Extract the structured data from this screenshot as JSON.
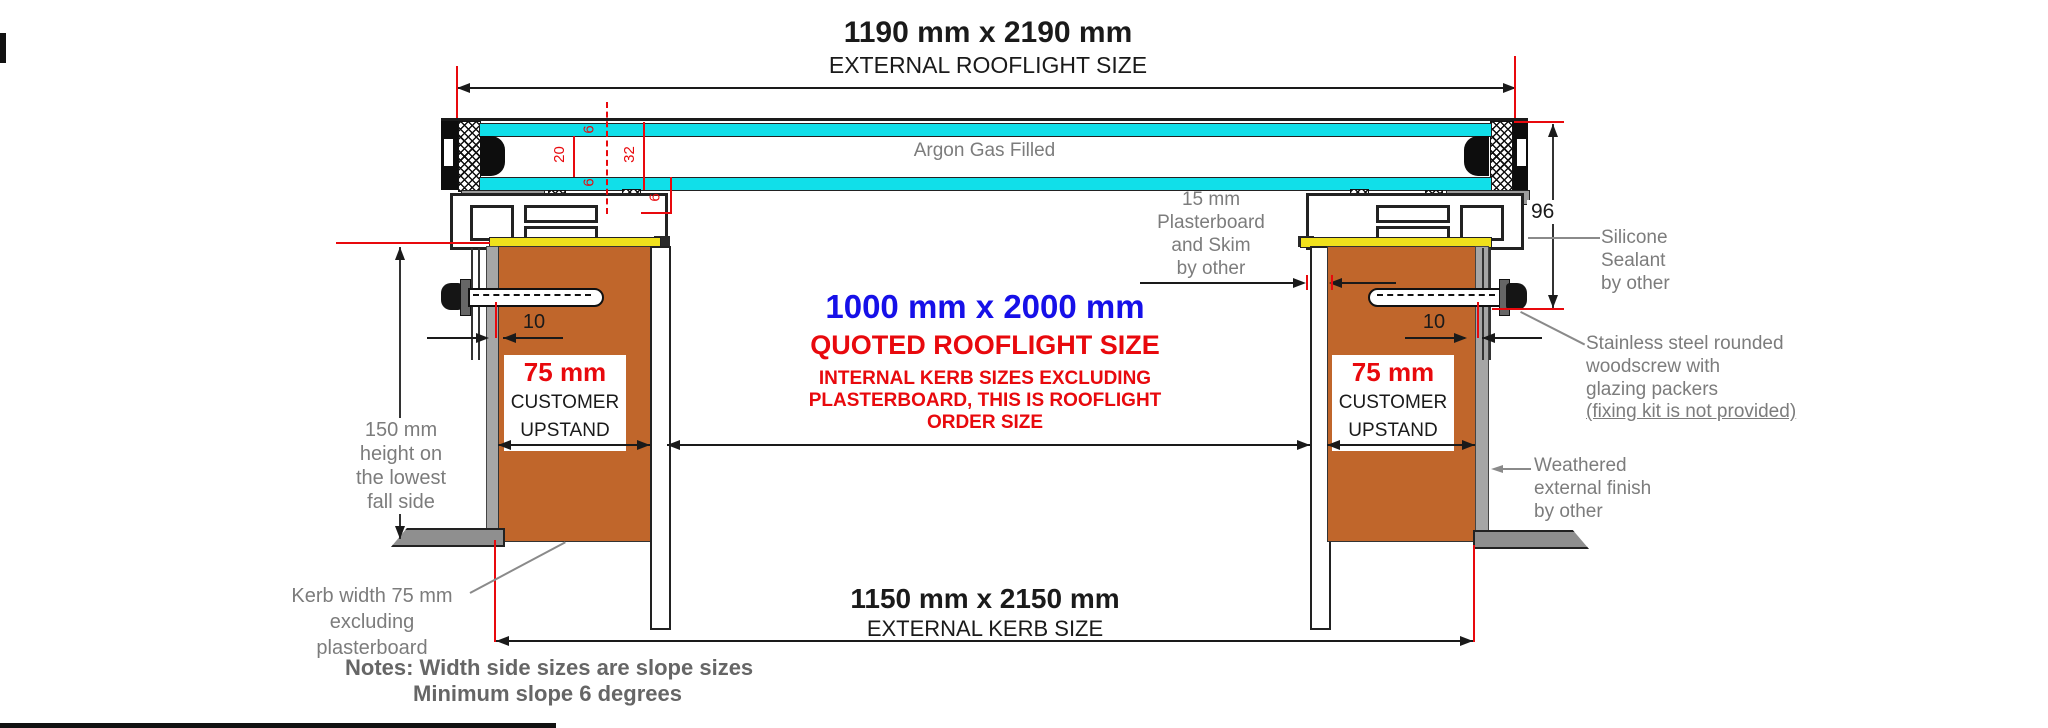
{
  "colors": {
    "glass_cyan": "#11dfe9",
    "kerb_brown": "#c0662b",
    "seal_yellow": "#f0e11c",
    "accent_red": "#e8090d",
    "accent_blue": "#1610e8",
    "annotation_gray": "#7c7c7c"
  },
  "top_dimension": {
    "size": "1190 mm x 2190 mm",
    "label": "EXTERNAL ROOFLIGHT SIZE"
  },
  "glazing": {
    "argon_label": "Argon Gas Filled",
    "dims": {
      "top_pane": "6",
      "cavity": "20",
      "unit": "32",
      "bottom_pane": "6",
      "edge": "6"
    }
  },
  "left_annotations": {
    "height_note": "150 mm\nheight on\nthe lowest\nfall side",
    "kerb_width_note": "Kerb width 75 mm\nexcluding plasterboard"
  },
  "right_annotations": {
    "plasterboard_note": "15 mm\nPlasterboard\nand Skim\nby other",
    "frame_height": "96",
    "silicone_note": "Silicone\nSealant\nby other",
    "screw_note": "Stainless steel rounded\nwoodscrew with\nglazing packers",
    "screw_note_underlined": "(fixing kit is not provided)",
    "weathered_note": "Weathered\nexternal finish\nby other"
  },
  "left_kerb": {
    "offset": "10",
    "size": "75 mm",
    "line1": "CUSTOMER",
    "line2": "UPSTAND"
  },
  "right_kerb": {
    "offset": "10",
    "size": "75 mm",
    "line1": "CUSTOMER",
    "line2": "UPSTAND"
  },
  "center": {
    "quoted_size": "1000 mm x 2000 mm",
    "quoted_label": "QUOTED ROOFLIGHT SIZE",
    "quoted_sub": "INTERNAL KERB SIZES EXCLUDING\nPLASTERBOARD, THIS IS ROOFLIGHT\nORDER SIZE"
  },
  "bottom_dimension": {
    "size": "1150 mm x 2150 mm",
    "label": "EXTERNAL KERB SIZE"
  },
  "notes": {
    "line1": "Notes: Width side sizes are slope sizes",
    "line2": "Minimum slope 6 degrees"
  }
}
